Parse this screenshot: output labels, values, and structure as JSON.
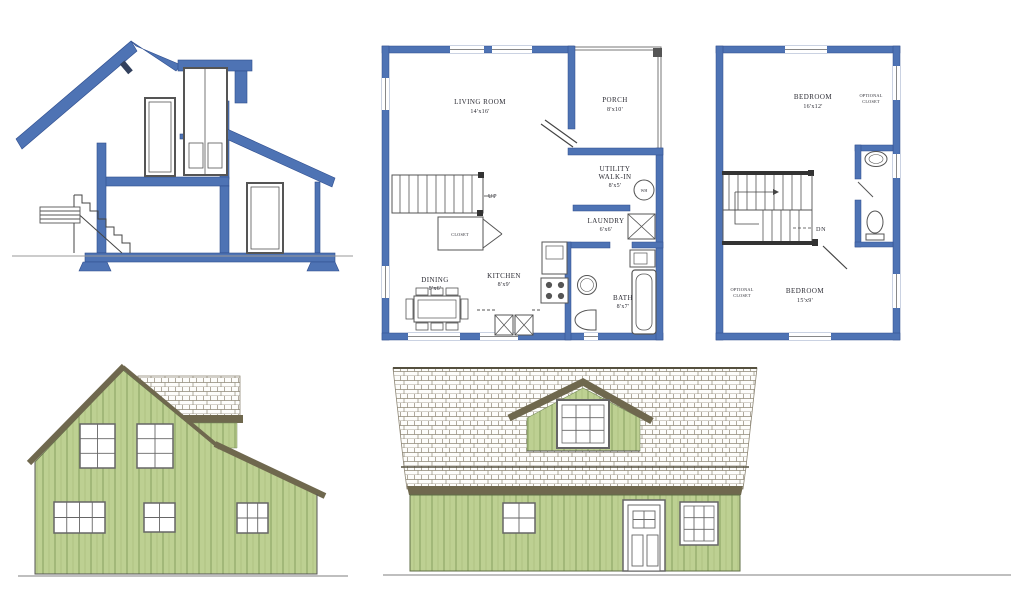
{
  "sheet": {
    "title": "Small house plan drawing set: cross-section, first and second floor plans, side and front elevations"
  },
  "colors": {
    "wall_blue": "#4e73b4",
    "wall_blue_dark": "#2e4d8e",
    "siding_green": "#bdd092",
    "siding_green_dark": "#8fa868",
    "roof_trim_olive": "#6f684e",
    "shingle_line": "#8f8877",
    "ink": "#3a3a3a"
  },
  "first_floor_plan": {
    "living_room": {
      "name": "LIVING ROOM",
      "size": "14'x16'"
    },
    "porch": {
      "name": "PORCH",
      "size": "8'x10'"
    },
    "utility": {
      "name_line1": "UTILITY",
      "name_line2": "WALK-IN",
      "size": "8'x5'"
    },
    "water_heater": {
      "name": "WH"
    },
    "laundry": {
      "name": "LAUNDRY",
      "size": "6'x6'"
    },
    "stairs": {
      "name": "UP"
    },
    "closet": {
      "name": "CLOSET"
    },
    "dining": {
      "name": "DINING",
      "size": "8'x6'"
    },
    "kitchen": {
      "name": "KITCHEN",
      "size": "8'x9'"
    },
    "bath": {
      "name": "BATH",
      "size": "8'x7'"
    }
  },
  "second_floor_plan": {
    "bedroom_upper": {
      "name": "BEDROOM",
      "size": "16'x12'"
    },
    "optional_closet_upper": {
      "line1": "OPTIONAL",
      "line2": "CLOSET"
    },
    "stairs": {
      "name": "DN"
    },
    "bedroom_lower": {
      "name": "BEDROOM",
      "size": "15'x9'"
    },
    "optional_closet_lower": {
      "line1": "OPTIONAL",
      "line2": "CLOSET"
    }
  }
}
